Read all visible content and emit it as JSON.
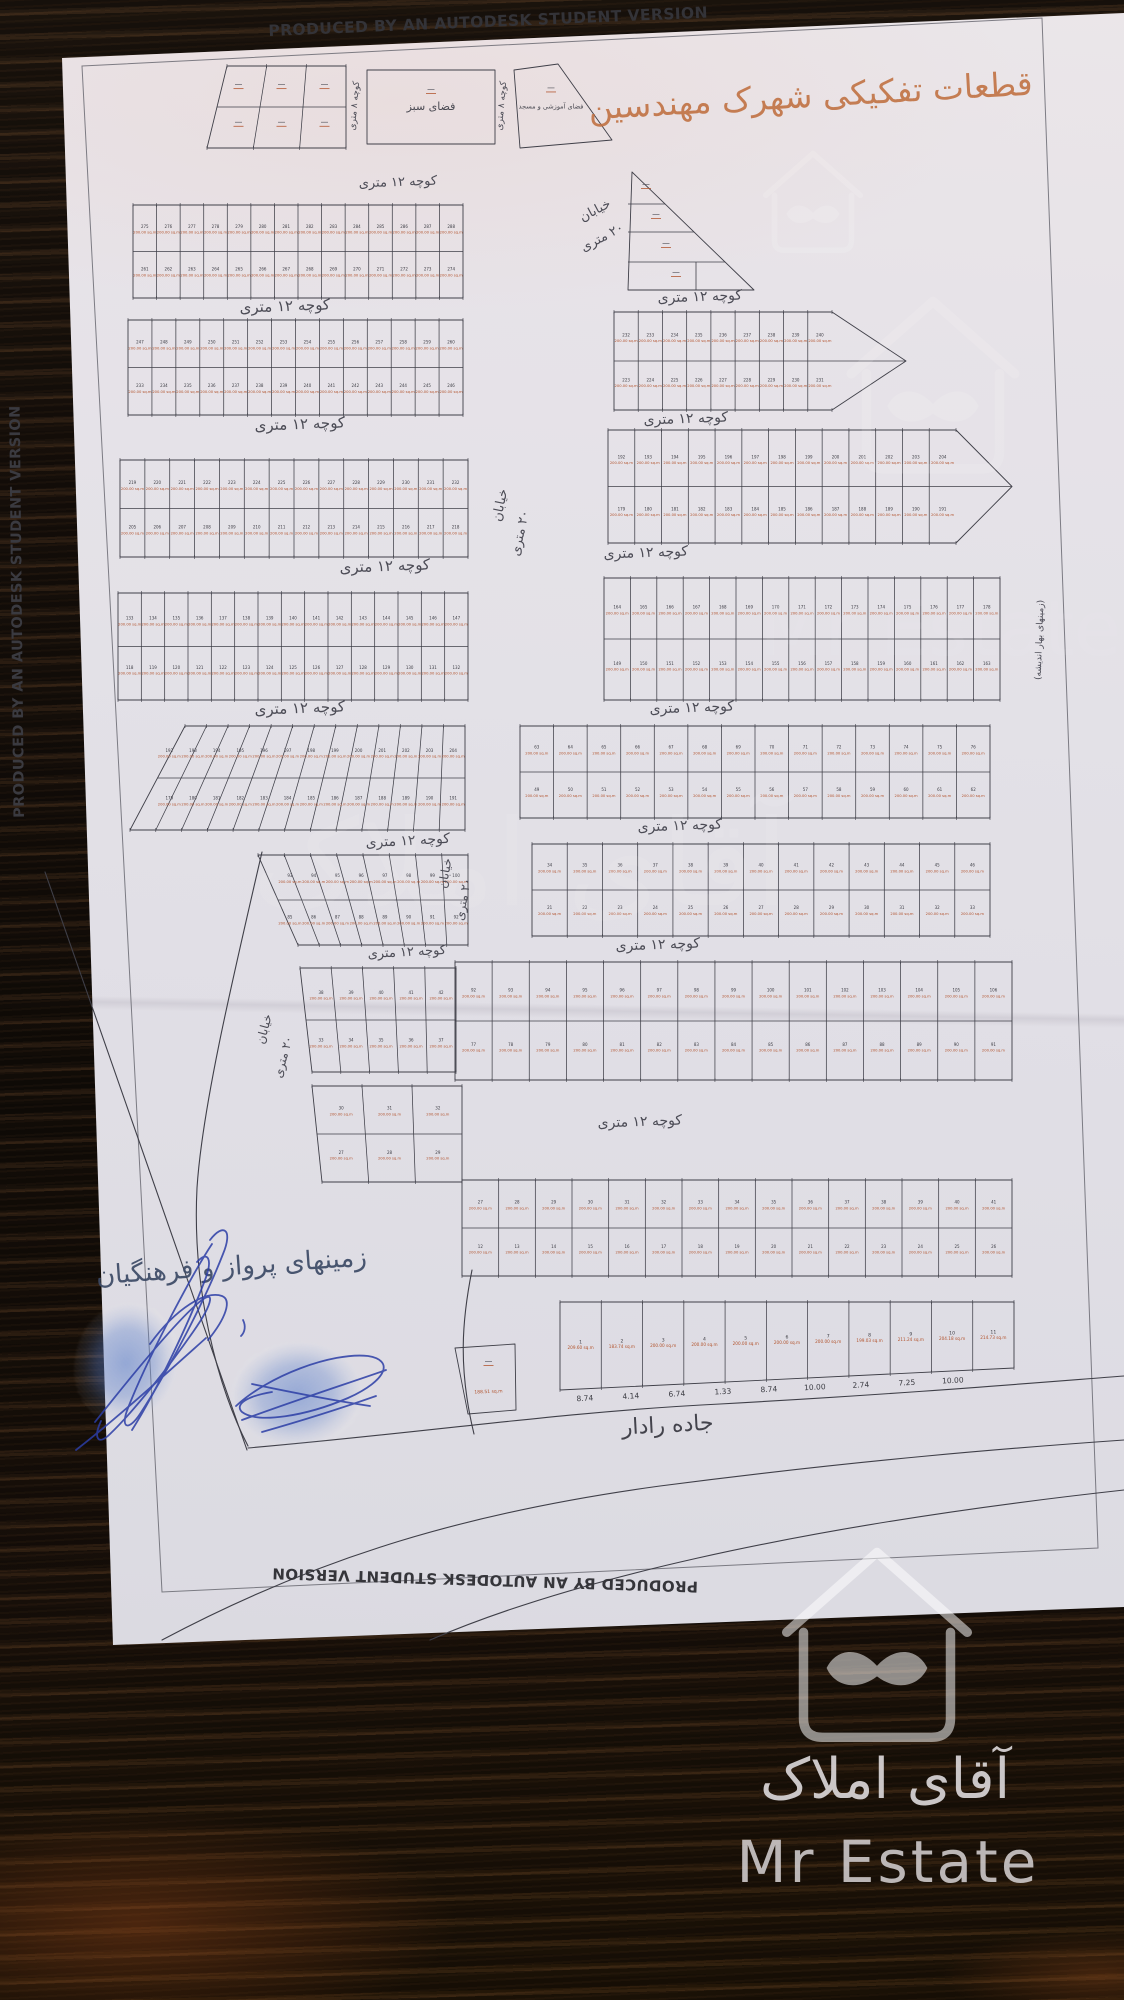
{
  "produced_by": "PRODUCED BY AN AUTODESK STUDENT VERSION",
  "title": "قطعات تفکیکی شهرک مهندسین",
  "labels": {
    "alley12": "کوچه ۱۲ متری",
    "alley8": "کوچه ۸ متری",
    "street20_l1": "خیابان",
    "street20_l2": "۲۰ متری",
    "radar_road": "جاده رادار",
    "green_space": "فضای سبز",
    "edu_mosque": "فضای آموزشی و مسجد",
    "side_note": "(زمینهای بهار اندیشه)",
    "handwriting": "زمینهای پرواز و فرهنگیان"
  },
  "watermark": {
    "fa": "آقای املاک",
    "en": "Mr Estate"
  },
  "plan": {
    "area_unit": "sq.m",
    "default_area": "200.00",
    "bottom_dims": [
      "8.74",
      "4.14",
      "6.74",
      "1.33",
      "8.74",
      "10.00",
      "2.74",
      "7.25",
      "10.00"
    ],
    "street_labels": [
      {
        "key": "alley12",
        "x": 398,
        "y": 186,
        "r": -2,
        "s": 13
      },
      {
        "key": "alley8",
        "x": 357,
        "y": 106,
        "r": -85,
        "s": 9
      },
      {
        "key": "alley8",
        "x": 504,
        "y": 106,
        "r": -85,
        "s": 9
      },
      {
        "key": "street20_l1",
        "x": 597,
        "y": 214,
        "r": -28,
        "s": 13
      },
      {
        "key": "street20_l2",
        "x": 604,
        "y": 241,
        "r": -28,
        "s": 13
      },
      {
        "key": "alley12",
        "x": 285,
        "y": 311,
        "r": -2,
        "s": 15
      },
      {
        "key": "alley12",
        "x": 700,
        "y": 301,
        "r": -2,
        "s": 14
      },
      {
        "key": "alley12",
        "x": 300,
        "y": 429,
        "r": -2,
        "s": 15
      },
      {
        "key": "alley12",
        "x": 686,
        "y": 423,
        "r": -2,
        "s": 14
      },
      {
        "key": "alley12",
        "x": 385,
        "y": 571,
        "r": -2,
        "s": 15
      },
      {
        "key": "alley12",
        "x": 646,
        "y": 557,
        "r": -2,
        "s": 14
      },
      {
        "key": "street20_l1",
        "x": 504,
        "y": 506,
        "r": -78,
        "s": 13
      },
      {
        "key": "street20_l2",
        "x": 524,
        "y": 534,
        "r": -78,
        "s": 13
      },
      {
        "key": "alley12",
        "x": 300,
        "y": 713,
        "r": -2,
        "s": 15
      },
      {
        "key": "alley12",
        "x": 692,
        "y": 712,
        "r": -2,
        "s": 14
      },
      {
        "key": "alley12",
        "x": 408,
        "y": 845,
        "r": -3,
        "s": 14
      },
      {
        "key": "alley12",
        "x": 680,
        "y": 830,
        "r": -2,
        "s": 14
      },
      {
        "key": "street20_l1",
        "x": 449,
        "y": 874,
        "r": -80,
        "s": 12
      },
      {
        "key": "street20_l2",
        "x": 467,
        "y": 900,
        "r": -80,
        "s": 12
      },
      {
        "key": "alley12",
        "x": 407,
        "y": 956,
        "r": -3,
        "s": 13
      },
      {
        "key": "alley12",
        "x": 658,
        "y": 949,
        "r": -2,
        "s": 14
      },
      {
        "key": "street20_l1",
        "x": 268,
        "y": 1030,
        "r": -75,
        "s": 12
      },
      {
        "key": "street20_l2",
        "x": 287,
        "y": 1058,
        "r": -75,
        "s": 12
      },
      {
        "key": "alley12",
        "x": 640,
        "y": 1126,
        "r": -2,
        "s": 14
      },
      {
        "key": "radar_road",
        "x": 668,
        "y": 1432,
        "r": -3,
        "s": 22
      },
      {
        "key": "side_note",
        "x": 1042,
        "y": 640,
        "r": -88,
        "s": 9
      }
    ],
    "roads": [
      "M45,872 L247,1450",
      "M262,852 C230,990 202,1110 197,1188 C192,1286 216,1384 248,1446",
      "M248,1448 C430,1432 560,1412 720,1404 C900,1394 1020,1384 1124,1376",
      "M162,1640 C320,1556 470,1512 660,1486 C860,1460 1010,1448 1124,1440",
      "M430,1640 C560,1584 780,1528 1124,1490",
      "M472,1270 C462,1320 458,1368 474,1434"
    ],
    "blocks": [
      {
        "id": "t1",
        "x": 207,
        "y": 66,
        "w": 139,
        "h": 82,
        "cols": 3,
        "rows": 2,
        "slantT": 20,
        "num_start": null
      },
      {
        "id": "t2",
        "type": "poly",
        "pts": [
          [
            367,
            70
          ],
          [
            495,
            70
          ],
          [
            495,
            144
          ],
          [
            367,
            144
          ]
        ],
        "label_key": "green_space",
        "label_size": 11
      },
      {
        "id": "t3",
        "type": "poly",
        "pts": [
          [
            514,
            70
          ],
          [
            558,
            64
          ],
          [
            612,
            140
          ],
          [
            520,
            148
          ]
        ],
        "label_key": "edu_mosque",
        "label_size": 6.5
      },
      {
        "id": "l1",
        "x": 133,
        "y": 205,
        "w": 330,
        "h": 93,
        "cols": 14,
        "rows": 2,
        "num_start": 261
      },
      {
        "id": "r1",
        "type": "tri",
        "pts": [
          [
            632,
            172
          ],
          [
            628,
            290
          ],
          [
            754,
            290
          ]
        ],
        "strips": [
          204,
          232,
          262
        ],
        "vline": 696
      },
      {
        "id": "l2",
        "x": 128,
        "y": 320,
        "w": 335,
        "h": 95,
        "cols": 14,
        "rows": 2,
        "num_start": 233
      },
      {
        "id": "r2",
        "x": 614,
        "y": 312,
        "w": 218,
        "h": 98,
        "cols": 9,
        "rows": 2,
        "num_start": 223,
        "tip": 74
      },
      {
        "id": "l3",
        "x": 120,
        "y": 460,
        "w": 348,
        "h": 97,
        "cols": 14,
        "rows": 2,
        "num_start": 205
      },
      {
        "id": "r3",
        "x": 608,
        "y": 430,
        "w": 348,
        "h": 113,
        "cols": 13,
        "rows": 2,
        "num_start": 179,
        "tip": 56
      },
      {
        "id": "l4",
        "x": 118,
        "y": 593,
        "w": 350,
        "h": 107,
        "cols": 15,
        "rows": 2,
        "num_start": 118
      },
      {
        "id": "r4",
        "x": 604,
        "y": 578,
        "w": 396,
        "h": 122,
        "cols": 15,
        "rows": 2,
        "num_start": 149
      },
      {
        "id": "l5",
        "x": 130,
        "y": 726,
        "w": 335,
        "h": 104,
        "cols": 13,
        "rows": 2,
        "num_start": 179,
        "slantT": 55
      },
      {
        "id": "r5",
        "x": 520,
        "y": 726,
        "w": 470,
        "h": 92,
        "cols": 14,
        "rows": 2,
        "num_start": 49
      },
      {
        "id": "l6",
        "x": 258,
        "y": 855,
        "w": 210,
        "h": 90,
        "cols": 8,
        "rows": 2,
        "num_start": 85,
        "slantB": 40
      },
      {
        "id": "r6",
        "x": 532,
        "y": 844,
        "w": 458,
        "h": 92,
        "cols": 13,
        "rows": 2,
        "num_start": 21
      },
      {
        "id": "l7",
        "x": 300,
        "y": 968,
        "w": 156,
        "h": 104,
        "cols": 5,
        "rows": 2,
        "num_start": 33,
        "slantB": 12
      },
      {
        "id": "r7",
        "x": 455,
        "y": 962,
        "w": 557,
        "h": 118,
        "cols": 15,
        "rows": 2,
        "num_start": 77
      },
      {
        "id": "l8",
        "x": 312,
        "y": 1086,
        "w": 150,
        "h": 96,
        "cols": 3,
        "rows": 2,
        "num_start": 27,
        "slantB": 10
      },
      {
        "id": "r8",
        "x": 462,
        "y": 1180,
        "w": 550,
        "h": 96,
        "cols": 15,
        "rows": 2,
        "num_start": 12
      },
      {
        "id": "r9",
        "x": 560,
        "y": 1302,
        "w": 454,
        "h": 88,
        "cols": 11,
        "rows": 1,
        "num_start": 1,
        "tiltB": -22,
        "areas": [
          "209.60",
          "183.74",
          "200.00",
          "200.00",
          "200.00",
          "200.00",
          "200.00",
          "199.03",
          "211.24",
          "204.18",
          "214.73"
        ]
      },
      {
        "id": "c1",
        "type": "poly",
        "pts": [
          [
            455,
            1348
          ],
          [
            515,
            1344
          ],
          [
            516,
            1410
          ],
          [
            468,
            1414
          ]
        ],
        "area": "188.51"
      }
    ]
  }
}
